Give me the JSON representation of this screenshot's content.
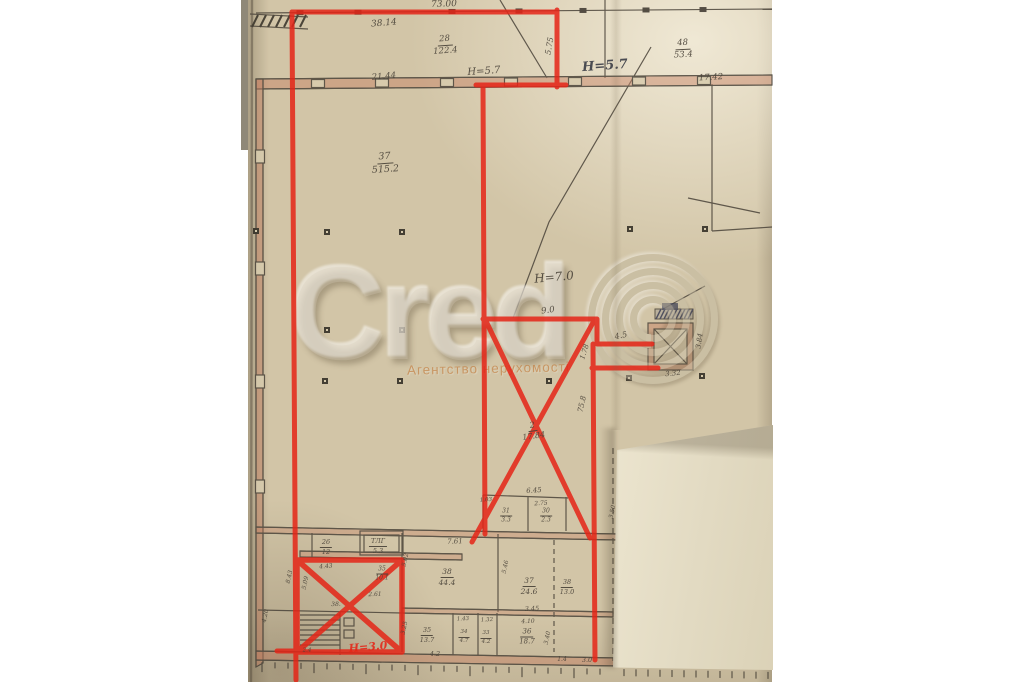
{
  "watermark": {
    "brand": "Credo",
    "subtitle": "Агентство нерухомості"
  },
  "colors": {
    "paper": "#d2c5a7",
    "paper_detail": "#d8ccae",
    "overlay_page": "#e2dac2",
    "marker_red": "#e52517",
    "pencil": "#4a4339",
    "wall_fill": "#c47a5c",
    "pen_ink": "#3e4049",
    "watermark_orange": "#c1702c",
    "elevator_hatch": "#3c3e54"
  },
  "labels": [
    {
      "t": "73.00",
      "x": 444,
      "y": 5,
      "s": 9,
      "r": -2
    },
    {
      "t": "38.14",
      "x": 384,
      "y": 24,
      "s": 9,
      "r": -5
    },
    {
      "t": "28",
      "b": "122.4",
      "x": 445,
      "y": 45,
      "s": 8.5,
      "r": -4,
      "n": "room-area-label"
    },
    {
      "t": "21.44",
      "x": 384,
      "y": 77,
      "s": 8.5,
      "r": -5
    },
    {
      "t": "H=5.7",
      "x": 484,
      "y": 72,
      "s": 10,
      "r": -4,
      "n": "height-note"
    },
    {
      "t": "5.75",
      "x": 550,
      "y": 46,
      "s": 8,
      "r": -80
    },
    {
      "t": "H=5.7",
      "x": 605,
      "y": 66,
      "s": 13,
      "r": -4,
      "c": "pen",
      "n": "height-note"
    },
    {
      "t": "48",
      "b": "53.4",
      "x": 683,
      "y": 49,
      "s": 8.5,
      "r": -3,
      "n": "room-area-label"
    },
    {
      "t": "17.42",
      "x": 711,
      "y": 78,
      "s": 8.5,
      "r": -3
    },
    {
      "t": "37",
      "b": "515.2",
      "x": 385,
      "y": 163,
      "s": 9.5,
      "r": -4,
      "n": "room-area-label"
    },
    {
      "t": "H=7.0",
      "x": 554,
      "y": 277,
      "s": 12,
      "r": -5,
      "n": "height-note"
    },
    {
      "t": "9.0",
      "x": 548,
      "y": 311,
      "s": 8.5,
      "r": -8
    },
    {
      "t": "4.5",
      "x": 621,
      "y": 336,
      "s": 8,
      "r": -12
    },
    {
      "t": "1.78",
      "x": 585,
      "y": 352,
      "s": 7,
      "r": -72
    },
    {
      "t": "3.84",
      "x": 700,
      "y": 341,
      "s": 7,
      "r": -82
    },
    {
      "t": "3.32",
      "x": 673,
      "y": 374,
      "s": 7,
      "r": -6
    },
    {
      "t": "75.8",
      "x": 582,
      "y": 404,
      "s": 7.5,
      "r": -78
    },
    {
      "t": "2",
      "b": "17.84",
      "x": 533,
      "y": 431,
      "s": 8,
      "r": -8,
      "n": "room-area-label"
    },
    {
      "t": "6.45",
      "x": 534,
      "y": 491,
      "s": 7,
      "r": -4
    },
    {
      "t": "1.03",
      "x": 486,
      "y": 501,
      "s": 5.5,
      "r": -3
    },
    {
      "t": "2.75",
      "x": 541,
      "y": 504,
      "s": 6,
      "r": -3
    },
    {
      "t": "31",
      "b": "3.3",
      "x": 506,
      "y": 516,
      "s": 6,
      "n": "room-area-label"
    },
    {
      "t": "30",
      "b": "2.3",
      "x": 546,
      "y": 516,
      "s": 6,
      "n": "room-area-label"
    },
    {
      "t": "3.50",
      "x": 613,
      "y": 512,
      "s": 6,
      "r": -78
    },
    {
      "t": "7.61",
      "x": 455,
      "y": 542,
      "s": 7,
      "r": -2
    },
    {
      "t": "26",
      "b": "12",
      "x": 326,
      "y": 547,
      "s": 6.5,
      "n": "room-area-label"
    },
    {
      "t": "ТЛГ",
      "b": "5.3",
      "x": 378,
      "y": 546,
      "s": 6.5,
      "n": "room-area-label"
    },
    {
      "t": "4.43",
      "x": 326,
      "y": 567,
      "s": 6,
      "r": -4
    },
    {
      "t": "8.43",
      "x": 290,
      "y": 577,
      "s": 6,
      "r": -78
    },
    {
      "t": "5.09",
      "x": 306,
      "y": 583,
      "s": 6,
      "r": -78
    },
    {
      "t": "35",
      "b": "10.1",
      "x": 382,
      "y": 574,
      "s": 6,
      "n": "room-area-label"
    },
    {
      "t": "5.02",
      "x": 406,
      "y": 560,
      "s": 6,
      "r": -78
    },
    {
      "t": "38",
      "b": "44.4",
      "x": 447,
      "y": 577,
      "s": 7.5,
      "n": "room-area-label"
    },
    {
      "t": "5.46",
      "x": 506,
      "y": 567,
      "s": 6,
      "r": -78
    },
    {
      "t": "37",
      "b": "24.6",
      "x": 529,
      "y": 586,
      "s": 7.5,
      "n": "room-area-label"
    },
    {
      "t": "38",
      "b": "13.0",
      "x": 567,
      "y": 587,
      "s": 6.5,
      "n": "room-area-label"
    },
    {
      "t": "2.61",
      "x": 375,
      "y": 595,
      "s": 6,
      "r": -2
    },
    {
      "t": "38.",
      "x": 336,
      "y": 605,
      "s": 6,
      "r": -2
    },
    {
      "t": "3.45",
      "x": 532,
      "y": 609,
      "s": 6.5,
      "r": -2
    },
    {
      "t": "1.43",
      "x": 463,
      "y": 620,
      "s": 5.5,
      "r": -2
    },
    {
      "t": "1.32",
      "x": 487,
      "y": 621,
      "s": 5.5,
      "r": -2
    },
    {
      "t": "4.10",
      "x": 528,
      "y": 622,
      "s": 6,
      "r": -2
    },
    {
      "t": "4.20",
      "x": 266,
      "y": 616,
      "s": 6,
      "r": -78
    },
    {
      "t": "35",
      "b": "13.7",
      "x": 427,
      "y": 635,
      "s": 6.5,
      "n": "room-area-label"
    },
    {
      "t": "34",
      "b": "4.7",
      "x": 464,
      "y": 637,
      "s": 5.5,
      "n": "room-area-label"
    },
    {
      "t": "33",
      "b": "4.2",
      "x": 486,
      "y": 638,
      "s": 5.5,
      "n": "room-area-label"
    },
    {
      "t": "36",
      "b": "18.7",
      "x": 527,
      "y": 637,
      "s": 7,
      "n": "room-area-label"
    },
    {
      "t": "3.40",
      "x": 548,
      "y": 638,
      "s": 6,
      "r": -78
    },
    {
      "t": "3.25",
      "x": 405,
      "y": 628,
      "s": 6,
      "r": -78
    },
    {
      "t": "2.4",
      "x": 307,
      "y": 651,
      "s": 5.5
    },
    {
      "t": "4.2",
      "x": 435,
      "y": 654,
      "s": 6.5
    },
    {
      "t": "1.4",
      "x": 562,
      "y": 660,
      "s": 6
    },
    {
      "t": "3.0",
      "x": 587,
      "y": 660,
      "s": 6.5
    },
    {
      "t": "H=3.0",
      "x": 368,
      "y": 647,
      "s": 11,
      "r": -5,
      "c": "red",
      "n": "red-height-note"
    }
  ]
}
